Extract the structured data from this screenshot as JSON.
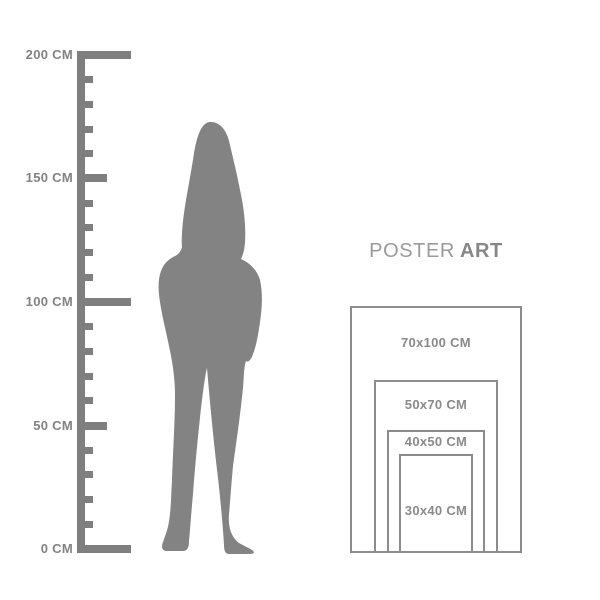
{
  "colors": {
    "background": "#ffffff",
    "ruler": "#7f7f7f",
    "ruler_text": "#828282",
    "silhouette": "#838383",
    "box_border": "#8c8c8c",
    "label_text": "#8a8a8a",
    "title_regular": "#9a9a9a",
    "title_bold": "#878787"
  },
  "ruler": {
    "unit": "CM",
    "min_cm": 0,
    "max_cm": 200,
    "tick_step_cm": 10,
    "labeled_ticks": [
      {
        "cm": 200,
        "label": "200 CM"
      },
      {
        "cm": 150,
        "label": "150 CM"
      },
      {
        "cm": 100,
        "label": "100 CM"
      },
      {
        "cm": 50,
        "label": "50 CM"
      },
      {
        "cm": 0,
        "label": "0 CM"
      }
    ]
  },
  "figure": {
    "icon": "standing-woman-silhouette"
  },
  "poster_chart": {
    "title": {
      "regular": "POSTER",
      "bold": "ART"
    },
    "sizes": [
      {
        "label": "70x100 CM",
        "width_cm": 70,
        "height_cm": 100
      },
      {
        "label": "50x70 CM",
        "width_cm": 50,
        "height_cm": 70
      },
      {
        "label": "40x50 CM",
        "width_cm": 40,
        "height_cm": 50
      },
      {
        "label": "30x40 CM",
        "width_cm": 30,
        "height_cm": 40
      }
    ]
  }
}
